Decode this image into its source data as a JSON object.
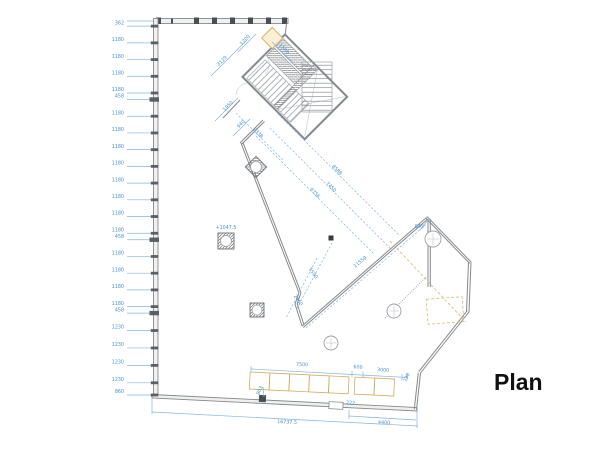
{
  "plan_label": "Plan",
  "colors": {
    "dimension_blue": "#4a90c8",
    "wall_gray": "#85898d",
    "accent_tan": "#d2aa5f"
  },
  "left_chain": [
    "362",
    "1180",
    "1180",
    "1180",
    "1180",
    "458",
    "1180",
    "1180",
    "1180",
    "1180",
    "1180",
    "1180",
    "1180",
    "1180",
    "458",
    "1180",
    "1180",
    "1180",
    "1180",
    "458",
    "1230",
    "1230",
    "1230",
    "1230",
    "860"
  ],
  "dims": {
    "d3129": "3129",
    "d1200": "1200",
    "d1500": "1500",
    "d1950": "1950",
    "d940": "940",
    "d2338": "2338",
    "d8588": "8588",
    "d7450": "7450",
    "d6756": "6756",
    "d5590": "5590",
    "d2460": "2460",
    "d11559": "11559",
    "d945": "945",
    "level": "+1047.5",
    "d7500": "7500",
    "d600": "600",
    "d3000": "3000",
    "d738": "738",
    "d222": "222",
    "d803": "803",
    "d4400": "4400",
    "dtotal": "16737.5"
  }
}
